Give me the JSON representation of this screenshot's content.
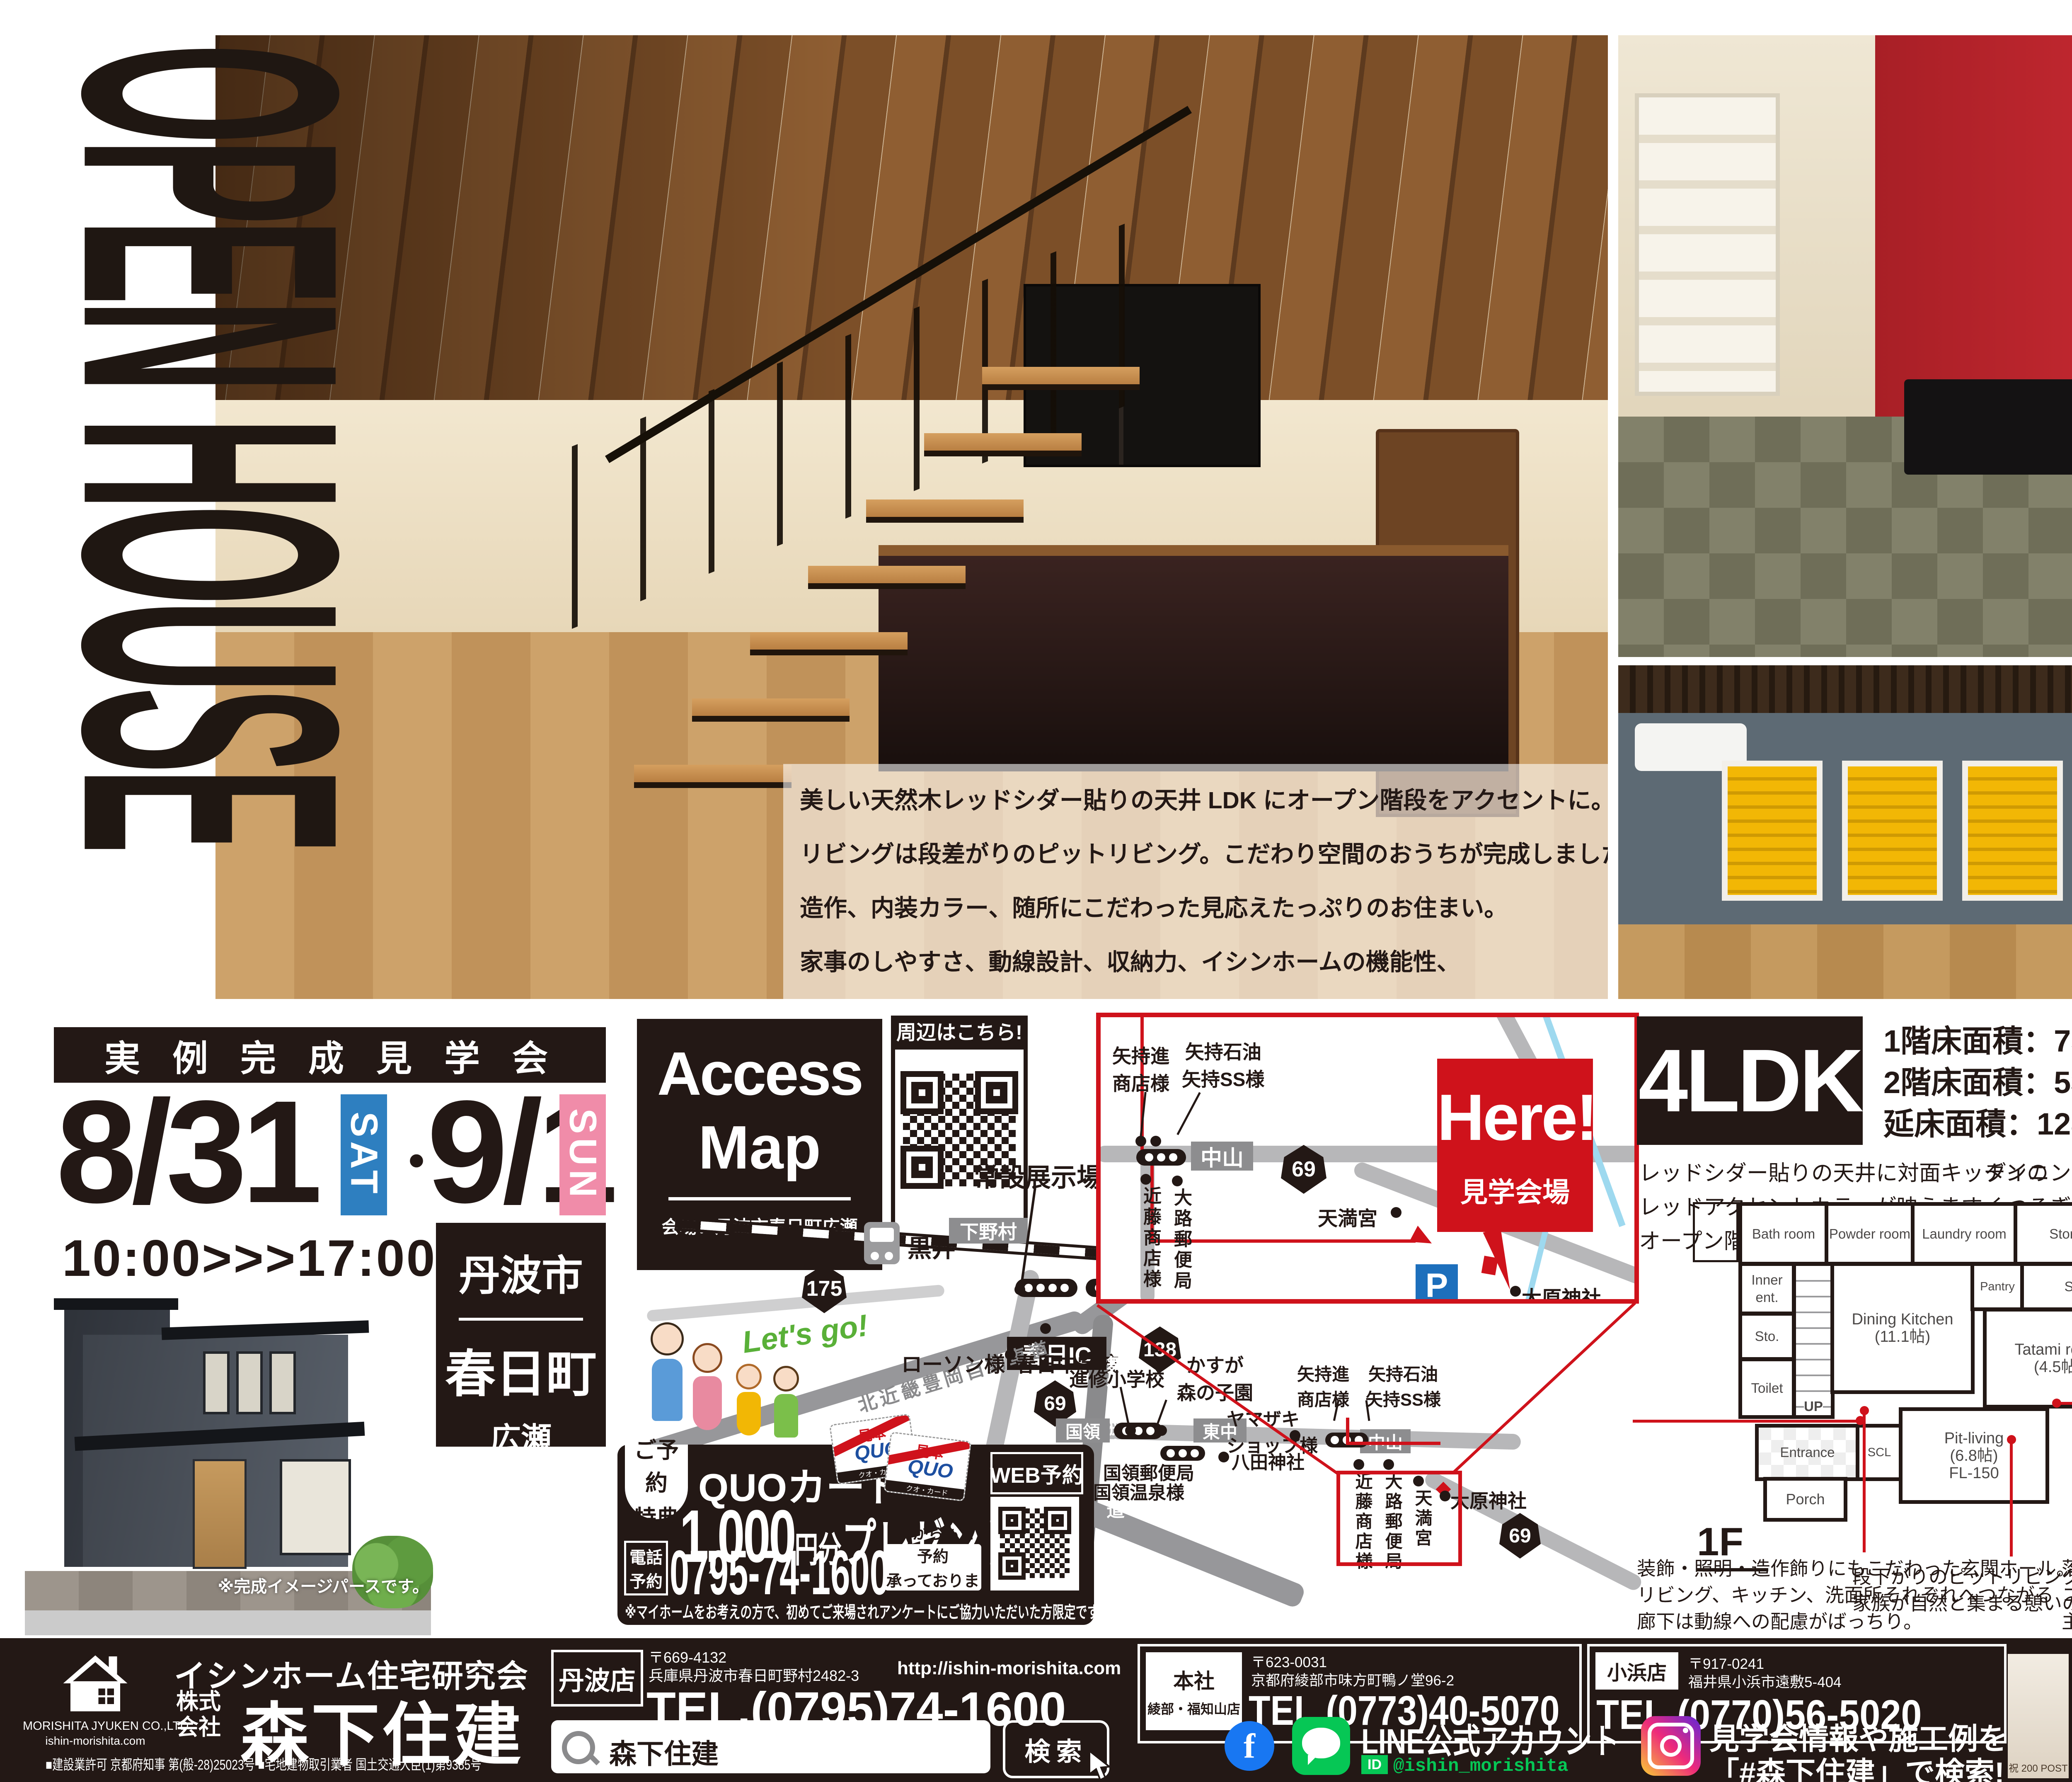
{
  "hero": {
    "title": "OPEN HOUSE",
    "description": [
      "美しい天然木レッドシダー貼りの天井 LDK にオープン階段をアクセントに。",
      "リビングは段差がりのピットリビング。こだわり空間のおうちが完成しました。",
      "造作、内装カラー、随所にこだわった見応えたっぷりのお住まい。",
      "家事のしやすさ、動線設計、収納力、イシンホームの機能性、",
      "ぜひ合わせて会場にてご覧くださいませ。ご来場お待ちしております。"
    ],
    "photo_note": "※全て実際にご覧いただく内観です。"
  },
  "event": {
    "title": "実例完成見学会",
    "date1": "8/31",
    "date1_dow": "SAT",
    "dot": "・",
    "date2": "9/1",
    "date2_dow": "SUN",
    "time": "10:00>>>17:00",
    "city": "丹波市",
    "town": "春日町",
    "district": "広瀬",
    "render_note": "※完成イメージパースです。"
  },
  "access": {
    "title1": "Access",
    "title2": "Map",
    "venue": "会場：丹波市春日町広瀬",
    "qr_label": "周辺はこちら!",
    "lets_go": "Let's go!"
  },
  "map": {
    "joset": "常設展示場",
    "kasuga_inter": "春日インター前",
    "shimonomura": "下野村",
    "kuroi": "黒井",
    "route175": "175",
    "kasuga_ic": "春日IC",
    "kitakinki": "北近畿豊岡自動車道",
    "lawson": "ローソン様",
    "kasuga_jhs": "春日中学校",
    "maizuru": "舞鶴若狭自動車道",
    "route138": "138",
    "route69": "69",
    "route69b": "69",
    "shinshu_es": "進修小学校",
    "kasuga_kids1": "かすが",
    "kasuga_kids2": "森の子園",
    "kokuryo": "国領",
    "higashinaka": "東中",
    "yamazaki1": "ヤマザキ",
    "yamazaki2": "ショップ様",
    "hatta": "八田神社",
    "kokuryo_po": "国領郵便局",
    "kokuryo_onsen": "国領温泉様",
    "nakayama": "中山",
    "yamochi1a": "矢持進",
    "yamochi1b": "商店様",
    "yamochi2a": "矢持石油",
    "yamochi2b": "矢持SS様",
    "kondo": "近藤商店様",
    "oji_po": "大路郵便局",
    "tenmangu": "天満宮",
    "ohara": "大原神社"
  },
  "inset": {
    "here": "Here!",
    "venue_label": "見学会場",
    "parking": "P",
    "nakayama": "中山",
    "route69": "69",
    "yamochi1a": "矢持進",
    "yamochi1b": "商店様",
    "yamochi2a": "矢持石油",
    "yamochi2b": "矢持SS様",
    "kondo": "近藤商店様",
    "oji_po": "大路郵便局",
    "tenmangu": "天満宮",
    "ohara": "大原神社"
  },
  "quo": {
    "benefit1": "ご予約",
    "benefit2": "特典",
    "quocard": "QUOカード",
    "amount": "1,000",
    "unit": "円分",
    "present": "プレゼント!",
    "tel1": "電話",
    "tel2": "予約",
    "tel": "0795-74-1600",
    "hp1": "HPからもご予約",
    "hp2": "承っております",
    "web": "WEB予約",
    "note": "※マイホームをお考えの方で、初めてご来場されアンケートにご協力いただいた方限定です。",
    "sample": "見本",
    "brand": "QUO",
    "brand_sub": "クオ・カード"
  },
  "spec": {
    "type": "4LDK",
    "line1": "1階床面積：75.35㎡(22.79坪)",
    "line2": "2階床面積：53.41㎡(16.16坪)",
    "line3": "延床面積：128.76㎡(38.95坪)"
  },
  "plans": {
    "note_kitchen": [
      "レッドシダー貼りの天井に対面キッチンの",
      "レッドアクセントカラーが映えます。",
      "オープン階段下には家事デスクを設けました。"
    ],
    "note_tatami": [
      "ダイニングに隣接する畳コーナーは",
      "くつろぎの空間を演出しました。"
    ],
    "note_children": [
      "2部屋の子供部屋。",
      "それぞれアクセントの内装カラーに",
      "こだわりを入れた仕上がりに。"
    ],
    "note_hall": [
      "装飾・照明・造作飾りにもこだわった玄関ホール。",
      "リビング、キッチン、洗面所それぞれへつながる",
      "廊下は動線への配慮がばっちり。"
    ],
    "note_pit": [
      "段下がりのピットリビングは",
      "家族が自然と集まる憩いの場。"
    ],
    "note_master": [
      "落ち着きのある、暖色系の色合い",
      "コーディネートでまとめられた",
      "主寝室で一日の疲れをリセット。"
    ],
    "note_wcl": [
      "収納力たっぷりの",
      "ウォークインクローゼット。",
      "お気に入りのキャラクターの",
      "壁紙を取り入れて毎日を楽しく♪"
    ],
    "f1": {
      "label": "1F",
      "bath": "Bath room",
      "powder": "Powder room",
      "laundry": "Laundry room",
      "storage": "Storage",
      "inner_ent": "Inner ent.",
      "sto1": "Sto.",
      "toilet": "Toilet",
      "dk": "Dining Kitchen",
      "dk_size": "(11.1帖)",
      "pantry": "Pantry",
      "sto2": "Sto.",
      "tatami": "Tatami room",
      "tatami_size": "(4.5帖)",
      "up": "UP",
      "entrance": "Entrance",
      "scl": "SCL",
      "porch": "Porch",
      "pit": "Pit-living",
      "pit_size": "(6.8帖)",
      "pit_fl": "FL-150"
    },
    "f2": {
      "label": "2F",
      "cl1": "CL",
      "child1": "Children's room",
      "child1_size": "(5.7帖)",
      "child2": "Children's room",
      "child2_size": "(5.7帖)",
      "cl2": "CL",
      "toilet": "Toilet",
      "dn": "DN",
      "sto": "Sto.",
      "wcl": "WCL",
      "balcony1": "Inner",
      "balcony2": "Balcony",
      "master": "Master bed room",
      "master_size": "(7.0帖)",
      "north": "N"
    }
  },
  "footer": {
    "brand_top": "イシンホーム住宅研究会",
    "kabu1": "株式",
    "kabu2": "会社",
    "company": "森下住建",
    "logo_name": "MORISHITA JYUKEN CO.,LTD",
    "logo_url": "ishin-morishita.com",
    "license": "■建設業許可 京都府知事 第(般-28)25023号 ■宅地建物取引業者 国土交通大臣(1)第9385号",
    "tanba_name": "丹波店",
    "tanba_zip": "〒669-4132",
    "tanba_addr": "兵庫県丹波市春日町野村2482-3",
    "tanba_url": "http://ishin-morishita.com",
    "tanba_tel": "TEL.(0795)74-1600",
    "honsha_name1": "本社",
    "honsha_name2": "綾部・福知山店",
    "honsha_zip": "〒623-0031",
    "honsha_addr": "京都府綾部市味方町鴨ノ堂96-2",
    "honsha_tel": "TEL.(0773)40-5070",
    "obama_name": "小浜店",
    "obama_zip": "〒917-0241",
    "obama_addr": "福井県小浜市遠敷5-404",
    "obama_tel": "TEL.(0770)56-5020",
    "search_text": "森下住建",
    "search_button": "検索",
    "fb_letter": "f",
    "line_label": "LINE公式アカウント",
    "line_id_label": "ID",
    "line_id": "@ishin_morishita",
    "insta1": "見学会情報や施工例を",
    "insta2": "「#森下住建」で検索!",
    "thumbs": [
      "祝 200 POST",
      "Special day!!",
      "Welcome to OPEN HOUSE",
      "Many thanks!!",
      "OPEN HOUSE",
      "OPEN HOUSE 見学会",
      "3会場同時開催 6/22・23",
      "OPEN HOUSE"
    ]
  }
}
